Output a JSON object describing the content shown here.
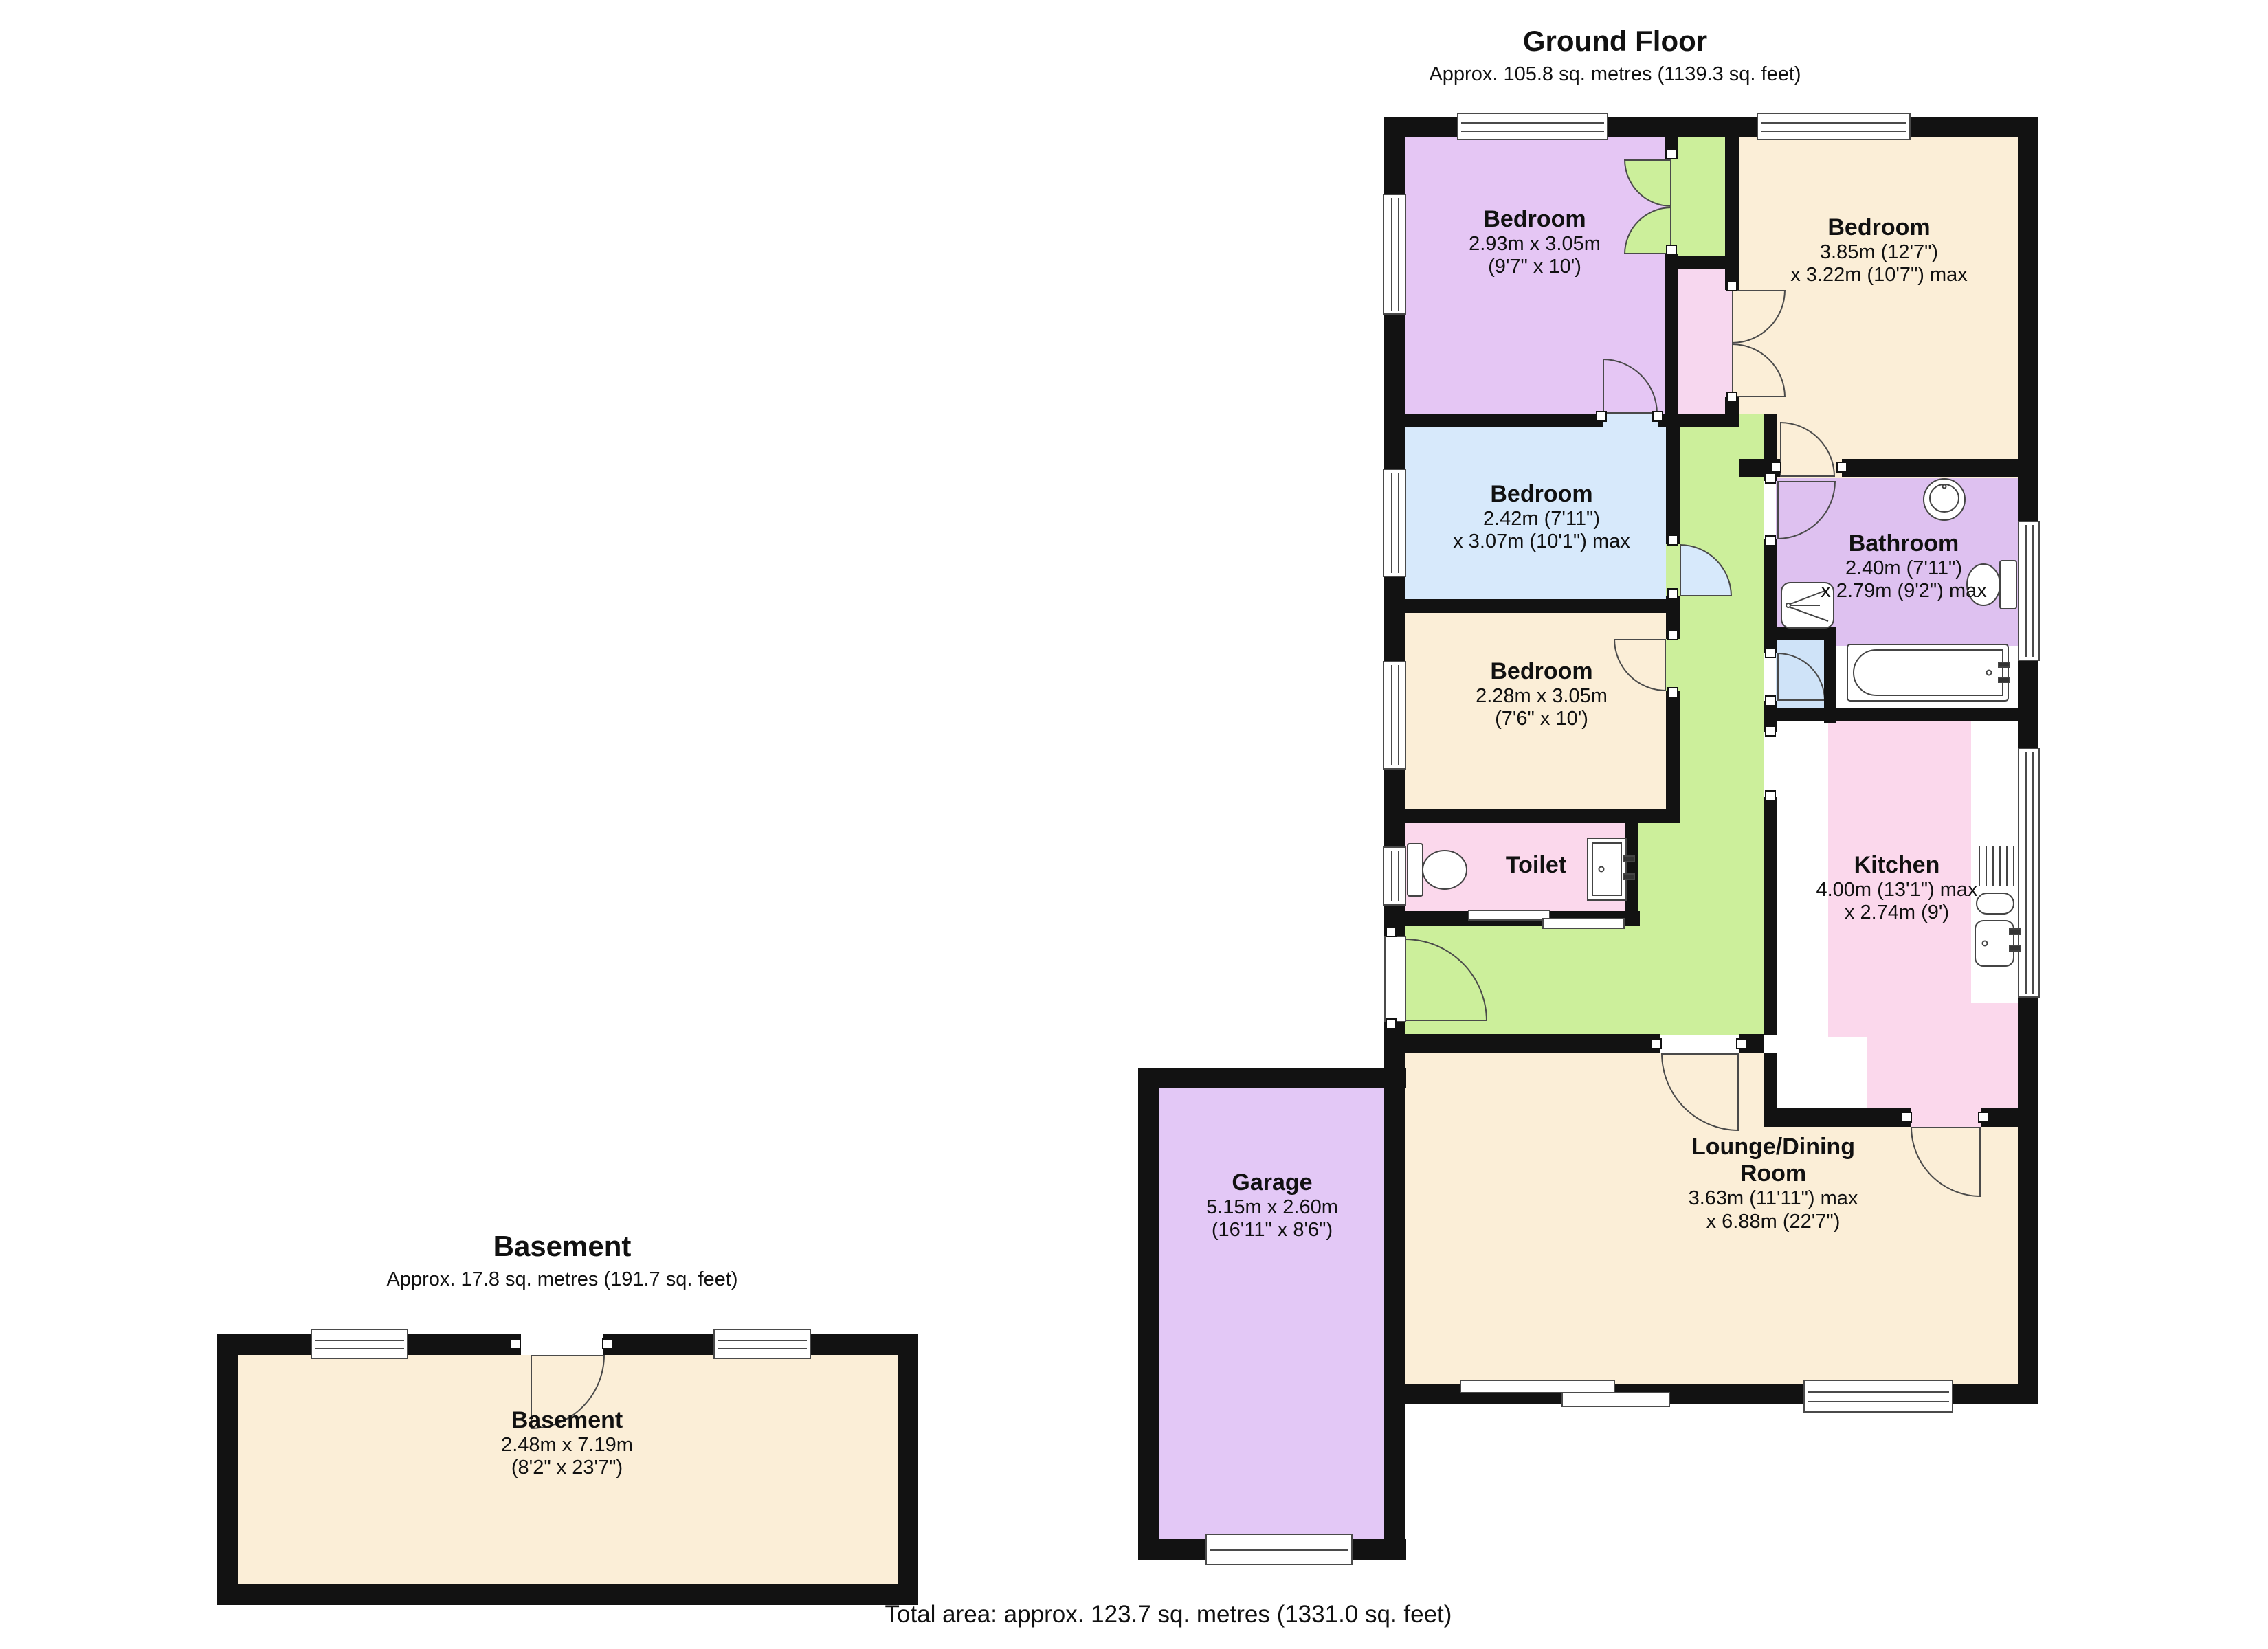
{
  "ground_floor": {
    "title": "Ground Floor",
    "subtitle": "Approx. 105.8 sq. metres (1139.3 sq. feet)"
  },
  "basement_section": {
    "title": "Basement",
    "subtitle": "Approx. 17.8 sq. metres (191.7 sq. feet)"
  },
  "total_area": "Total area: approx. 123.7 sq. metres (1331.0 sq. feet)",
  "rooms": {
    "bedroom_tl": {
      "name": "Bedroom",
      "dim1": "2.93m x 3.05m",
      "dim2": "(9'7\" x 10')"
    },
    "bedroom_tr": {
      "name": "Bedroom",
      "dim1": "3.85m (12'7\")",
      "dim2": "x 3.22m (10'7\") max"
    },
    "bedroom_mid": {
      "name": "Bedroom",
      "dim1": "2.42m (7'11\")",
      "dim2": "x 3.07m (10'1\") max"
    },
    "bathroom": {
      "name": "Bathroom",
      "dim1": "2.40m (7'11\")",
      "dim2": "x 2.79m (9'2\") max"
    },
    "bedroom_small": {
      "name": "Bedroom",
      "dim1": "2.28m x 3.05m",
      "dim2": "(7'6\" x 10')"
    },
    "toilet": {
      "name": "Toilet"
    },
    "kitchen": {
      "name": "Kitchen",
      "dim1": "4.00m (13'1\") max",
      "dim2": "x 2.74m (9')"
    },
    "lounge": {
      "name_line1": "Lounge/Dining",
      "name_line2": "Room",
      "dim1": "3.63m (11'11\") max",
      "dim2": "x 6.88m (22'7\")"
    },
    "garage": {
      "name": "Garage",
      "dim1": "5.15m x 2.60m",
      "dim2": "(16'11\" x 8'6\")"
    },
    "basement": {
      "name": "Basement",
      "dim1": "2.48m x 7.19m",
      "dim2": "(8'2\" x 23'7\")"
    }
  },
  "colors": {
    "wall": "#121212",
    "bedroom_purple": "#e5c6f4",
    "garage_purple": "#e3c8f6",
    "bathroom_purple": "#dec1f0",
    "cream": "#fbeed7",
    "blue": "#d7e9fb",
    "cupboard_blue": "#cfe3f8",
    "green": "#ccef9b",
    "pink": "#fbd8ec",
    "pink_closet": "#f7d7ef"
  }
}
